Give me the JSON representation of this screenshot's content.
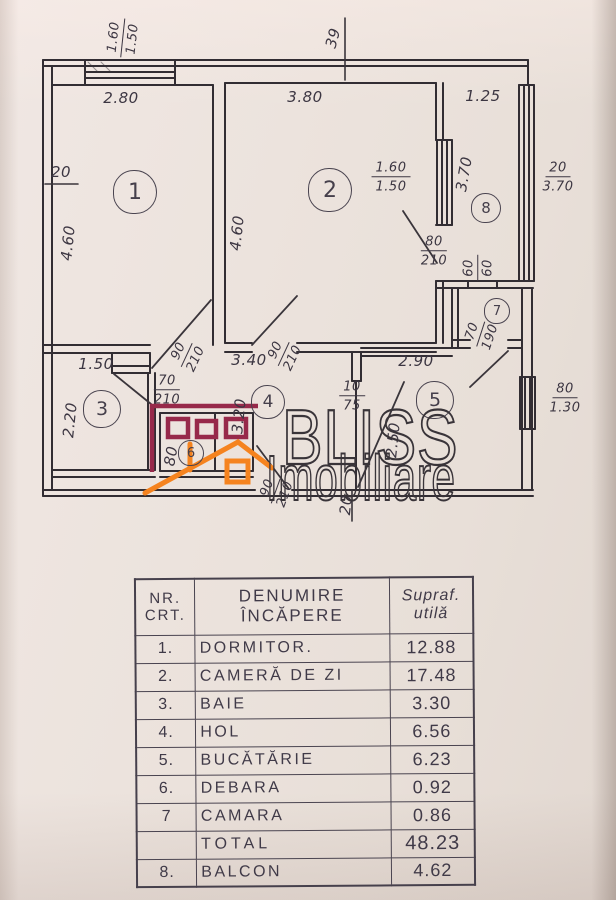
{
  "colors": {
    "maroon": "#97294a",
    "orange": "#f5831f",
    "ink": "#322d33",
    "paper": "#eae1da"
  },
  "logo": {
    "brand": "BLISS",
    "subtitle": "Imobiliare"
  },
  "plan": {
    "rooms": [
      {
        "number": "1",
        "x": 135,
        "y": 192,
        "r": 22
      },
      {
        "number": "2",
        "x": 330,
        "y": 190,
        "r": 22
      },
      {
        "number": "3",
        "x": 102,
        "y": 409,
        "r": 19
      },
      {
        "number": "4",
        "x": 268,
        "y": 402,
        "r": 17
      },
      {
        "number": "5",
        "x": 435,
        "y": 400,
        "r": 19
      },
      {
        "number": "6",
        "x": 191,
        "y": 453,
        "r": 13
      },
      {
        "number": "7",
        "x": 497,
        "y": 311,
        "r": 13
      },
      {
        "number": "8",
        "x": 486,
        "y": 208,
        "r": 15
      }
    ],
    "labels": [
      {
        "top": "1.60",
        "bottom": "1.50",
        "x": 123,
        "y": 38,
        "rot": -84
      },
      {
        "text": "39",
        "x": 333,
        "y": 38,
        "rot": -75
      },
      {
        "text": "2.80",
        "x": 121,
        "y": 98
      },
      {
        "text": "3.80",
        "x": 305,
        "y": 97
      },
      {
        "text": "1.25",
        "x": 483,
        "y": 96
      },
      {
        "top": "20",
        "bottom": "3.70",
        "x": 558,
        "y": 177
      },
      {
        "text": "4.60",
        "x": 68,
        "y": 243,
        "rot": -84
      },
      {
        "text": "4.60",
        "x": 237,
        "y": 233,
        "rot": -84
      },
      {
        "top": "1.60",
        "bottom": "1.50",
        "x": 391,
        "y": 177
      },
      {
        "text": "3.70",
        "x": 464,
        "y": 174,
        "rot": -80
      },
      {
        "top": "80",
        "bottom": "210",
        "x": 434,
        "y": 251
      },
      {
        "top": "60",
        "bottom": "60",
        "x": 478,
        "y": 268,
        "rot": -90
      },
      {
        "top": "70",
        "bottom": "190",
        "x": 481,
        "y": 334,
        "rot": -72
      },
      {
        "text": "2.90",
        "x": 416,
        "y": 361
      },
      {
        "top": "80",
        "bottom": "1.30",
        "x": 565,
        "y": 398
      },
      {
        "text": "1.50",
        "x": 96,
        "y": 364
      },
      {
        "text": "2.20",
        "x": 70,
        "y": 420,
        "rot": -84
      },
      {
        "top": "70",
        "bottom": "210",
        "x": 167,
        "y": 390
      },
      {
        "top": "90",
        "bottom": "210",
        "x": 187,
        "y": 355,
        "rot": -65
      },
      {
        "text": "3.40",
        "x": 249,
        "y": 360
      },
      {
        "top": "90",
        "bottom": "210",
        "x": 284,
        "y": 354,
        "rot": -65
      },
      {
        "text": "3.20",
        "x": 239,
        "y": 416,
        "rot": -84
      },
      {
        "text": "80",
        "x": 171,
        "y": 456,
        "rot": -80
      },
      {
        "top": "10",
        "bottom": "75",
        "x": 352,
        "y": 396
      },
      {
        "text": "2.50",
        "x": 393,
        "y": 440,
        "rot": -84
      },
      {
        "top": "90",
        "bottom": "210",
        "x": 276,
        "y": 491,
        "rot": -70
      },
      {
        "text": "20",
        "x": 346,
        "y": 505,
        "rot": -84
      },
      {
        "text": "20",
        "x": 61,
        "y": 172
      }
    ]
  },
  "table": {
    "headers": [
      {
        "line1": "NR.",
        "line2": "CRT."
      },
      {
        "line1": "DENUMIRE",
        "line2": "ÎNCĂPERE"
      },
      {
        "line1": "Supraf.",
        "line2": "utilă"
      }
    ],
    "rows": [
      {
        "nr": "1.",
        "name": "DORMITOR.",
        "value": "12.88",
        "total": false
      },
      {
        "nr": "2.",
        "name": "CAMERĂ DE ZI",
        "value": "17.48",
        "total": false
      },
      {
        "nr": "3.",
        "name": "BAIE",
        "value": "3.30",
        "total": false
      },
      {
        "nr": "4.",
        "name": "HOL",
        "value": "6.56",
        "total": false
      },
      {
        "nr": "5.",
        "name": "BUCĂTĂRIE",
        "value": "6.23",
        "total": false
      },
      {
        "nr": "6.",
        "name": "DEBARA",
        "value": "0.92",
        "total": false
      },
      {
        "nr": "7",
        "name": "CAMARA",
        "value": "0.86",
        "total": false
      },
      {
        "nr": "",
        "name": "TOTAL",
        "value": "48.23",
        "total": true
      },
      {
        "nr": "8.",
        "name": "BALCON",
        "value": "4.62",
        "total": false
      }
    ]
  }
}
